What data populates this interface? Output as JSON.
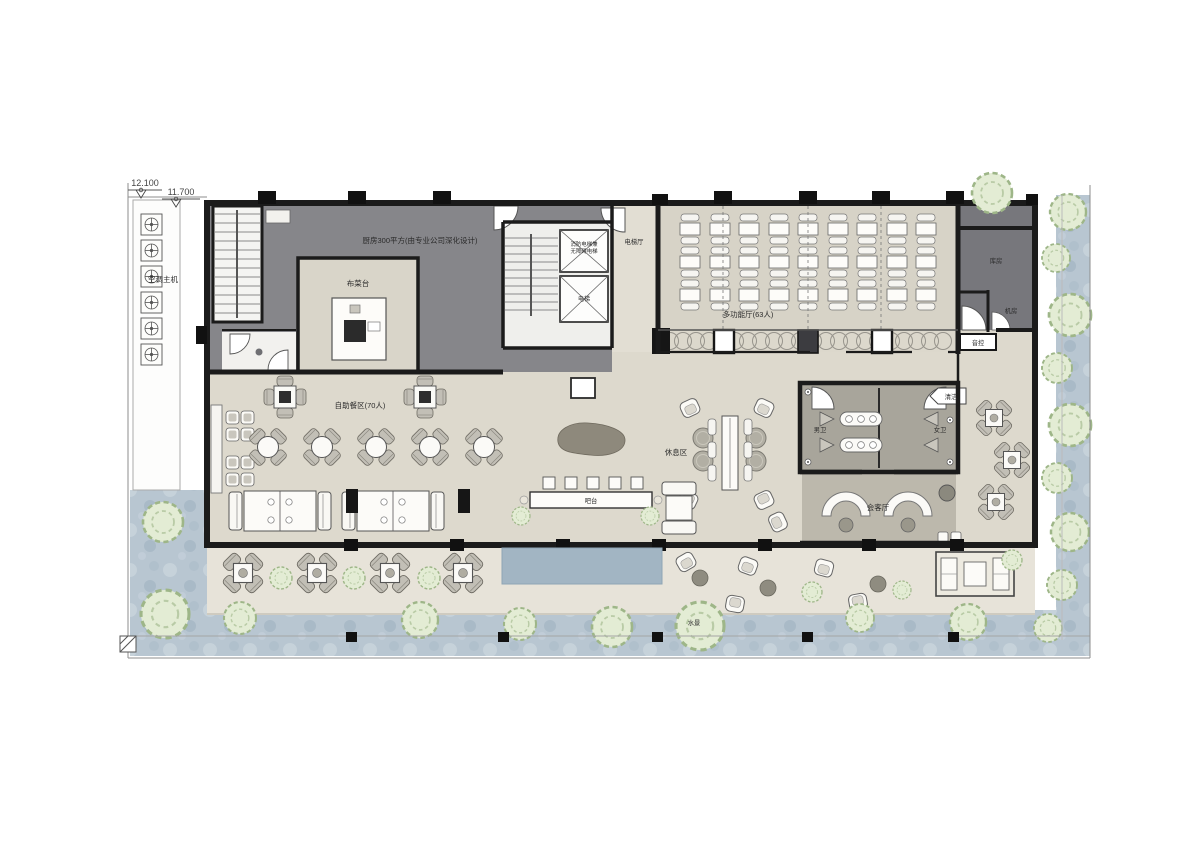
{
  "drawing": {
    "type": "architectural-floor-plan",
    "description": "Hotel/restaurant floor plan with buffet dining, multi-function hall, kitchen and outdoor terrace"
  },
  "elevations": {
    "upper": "12.100",
    "lower": "11.700"
  },
  "labels": {
    "ac": "空调主机",
    "kitchen": "厨房300平方(由专业公司深化设计)",
    "serving_counter": "布菜台",
    "elevator_hall": "电梯厅",
    "fire_elevator_l1": "消防电梯兼",
    "fire_elevator_l2": "无障碍电梯",
    "elevator": "电梯",
    "hall": "多功能厅(63人)",
    "storage": "库房",
    "machine_room": "机房",
    "audio_control": "音控",
    "buffet": "自助餐区(70人)",
    "bar": "吧台",
    "lounge": "休息区",
    "mens_wc": "男卫",
    "womens_wc": "女卫",
    "cleaning": "清洁",
    "reception": "会客厅",
    "water_feature": "水景"
  },
  "colors": {
    "wall": "#1b1b1b",
    "kitchen_floor": "#86868a",
    "dark_room": "#77777c",
    "dining_floor": "#ddd9cd",
    "hall_floor": "#d7d3c7",
    "restroom_floor": "#a8a59b",
    "reception_floor": "#bcb8ac",
    "deck": "#e7e3d9",
    "water": "#b8c6d1",
    "pool": "#a2b5c3",
    "tree_fill": "#e3ecd4",
    "tree_stroke": "#9eb688"
  }
}
